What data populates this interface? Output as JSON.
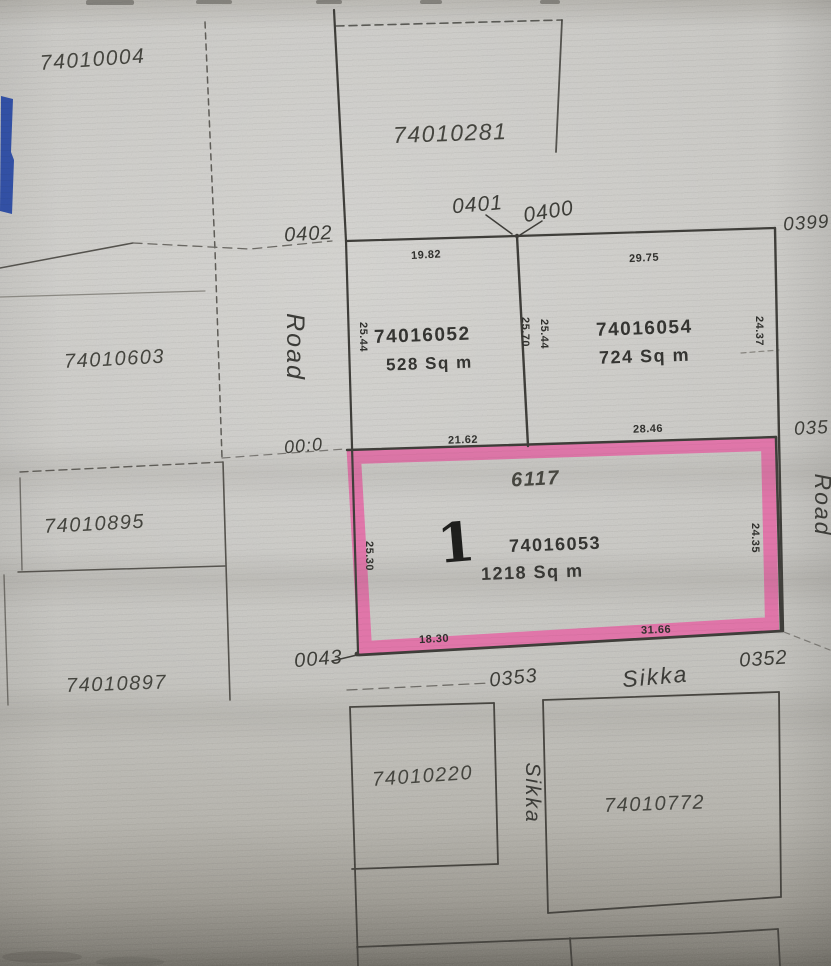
{
  "document_type": "cadastral plot plan scan",
  "colors": {
    "highlight_pink": "#e467a5",
    "pen_blue": "#2647a2",
    "paper": "#c9c8c4",
    "ink": "#3f3e3a"
  },
  "plots": {
    "p74010004": {
      "label": "74010004"
    },
    "p74010281": {
      "label": "74010281"
    },
    "p74010603": {
      "label": "74010603"
    },
    "p74010895": {
      "label": "74010895"
    },
    "p74010897": {
      "label": "74010897"
    },
    "p74010220": {
      "label": "74010220"
    },
    "p74010772": {
      "label": "74010772"
    },
    "p74016052": {
      "number": "74016052",
      "area": "528 Sq m",
      "dim_top": "19.82",
      "dim_left": "25.44",
      "dim_right_inner": "25.70"
    },
    "p74016054": {
      "number": "74016054",
      "area": "724 Sq m",
      "dim_top": "29.75",
      "dim_left_inner": "25.44",
      "dim_right": "24.37"
    },
    "p74016053": {
      "number": "74016053",
      "area": "1218 Sq m",
      "plot_no": "6117",
      "handwritten_mark": "1",
      "dim_top_left": "21.62",
      "dim_top_right": "28.46",
      "dim_left": "25.30",
      "dim_right": "24.35",
      "dim_bottom_left": "18.30",
      "dim_bottom_right": "31.66"
    }
  },
  "corners": {
    "c0402": "0402",
    "c0401": "0401",
    "c0400": "0400",
    "c0399": "0399",
    "c035": "035",
    "c000": "00:0",
    "c0043": "0043",
    "c0353": "0353",
    "c0352": "0352"
  },
  "roads": {
    "left_road": "Road",
    "right_road": "Road",
    "sikka_bottom": "Sikka",
    "sikka_lane": "Sikka"
  }
}
